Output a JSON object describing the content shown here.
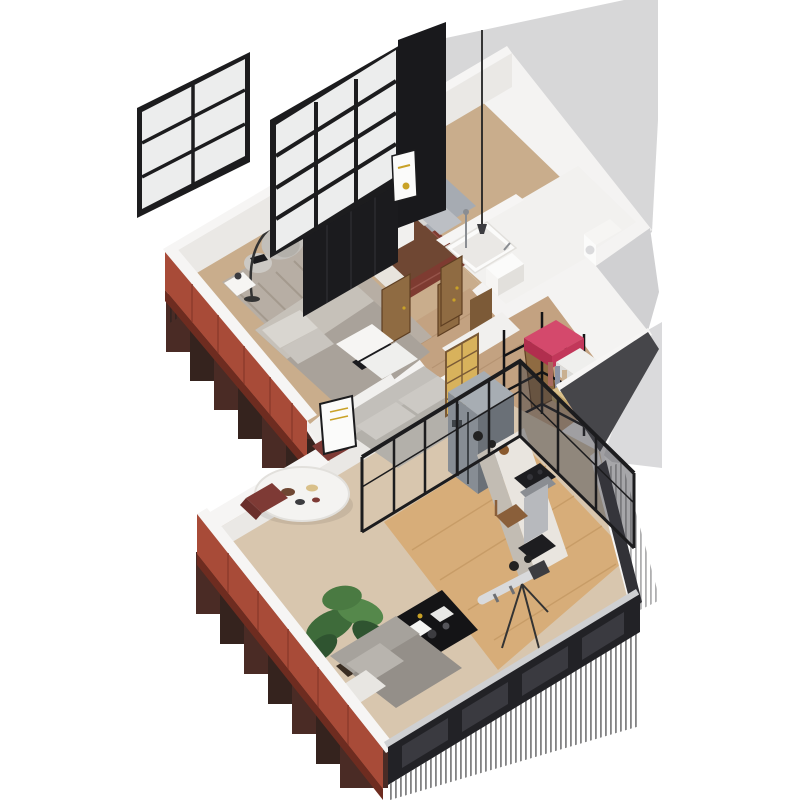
{
  "meta": {
    "type": "isometric-3d-floorplan-render",
    "view": "cutaway axonometric apartment visualization",
    "background": "#ffffff",
    "visible_text": "none"
  },
  "palette": {
    "bg": "#ffffff",
    "silhouette": "#f4f3f2",
    "wallTop": "#f6f5f4",
    "wallInner": "#eae8e5",
    "wallFace": "#f1f0ee",
    "grayWall": "#d7d7d8",
    "grayBand": "#dadadc",
    "grayBand2": "#d0d0d2",
    "darkWedge": "#46464a",
    "red": "#a84b38",
    "redDark": "#8c3a2c",
    "redShadow": "#6e2c20",
    "step1": "#3b1a13",
    "step2": "#24110c",
    "stripe": "#1b1b1d",
    "frame": "#1c1c1e",
    "glass": "#eceded",
    "slab": "#19191c",
    "blackFurn": "#1b1b1e",
    "blackFurnTop": "#333338",
    "woodFloor": "#c9ad8c",
    "hallFloor": "#c3a281",
    "plank": "#b2906f",
    "studioFloor": "#d7ad79",
    "studioPlank": "#c59a64",
    "livingFloor": "#d8c6ae",
    "rugGray": "#b7aea4",
    "rugStripe": "#a49a8e",
    "rugRed": "#7e3b31",
    "rugRedLight": "#96544a",
    "bed1": "#a9a29a",
    "bed1Light": "#c6c1b9",
    "pillow": "#d9d6d0",
    "pillow2": "#c9c5bf",
    "bed2": "#6f4733",
    "sheet": "#e8e4dd",
    "headboard": "#a6abb2",
    "pillowB": "#d8d7d4",
    "pillowB2": "#bcbfc4",
    "white": "#fbfbfa",
    "porcelain": "#f6f5f3",
    "tile": "#f2f1ef",
    "steel": "#b7b9bd",
    "steelDark": "#8a8d92",
    "doorWood": "#8f6b42",
    "doorWoodDark": "#5f3f22",
    "doorWood2": "#7c5a37",
    "gold": "#c9a227",
    "shojiGold": "#d8b25c",
    "shojiFrame": "#7a5a36",
    "shelf": "#141416",
    "suitcase": "#c2375a",
    "suitcaseTop": "#d4496c",
    "suitcaseDark": "#b12e4e",
    "boxWhite": "#efefed",
    "boxWhite2": "#dcdcda",
    "basket": "#d9c08a",
    "basketDark": "#c0a469",
    "tableWhite": "#f4f3f1",
    "tableRim": "#e2e0dc",
    "chairMaroon": "#7e3a35",
    "chairMaroonDark": "#6a2f2b",
    "sofaBack": "#c2bfba",
    "sofaSeat": "#b3b0aa",
    "sofaCushion": "#ccc9c4",
    "sofa2Back": "#a6a29c",
    "sofa2Seat": "#948f89",
    "sofa2Cushion": "#b8b4ae",
    "blanketWhite": "#e8e6e2",
    "plantPot": "#3a2d22",
    "green1": "#3e6b3a",
    "green2": "#55884b",
    "green3": "#2f5430",
    "green4": "#4a7a42",
    "fridgeTop": "#a7adb3",
    "fridgeL": "#878d94",
    "fridgeR": "#6a7077",
    "fridgeHandle": "#3f4449",
    "counterTop": "#e9e5df",
    "counterFace": "#c2bcb3",
    "stove": "#1d1d20",
    "darkWallB": "#222226",
    "darkWallB2": "#3a3a40",
    "darkWallR": "#323237",
    "lightStrip": "#cfd0d2",
    "lens": "#d9dadc",
    "lensDark": "#6d6f73",
    "tripod": "#333333",
    "deskChair": "#5b3f2a",
    "chairWood": "#8a5f3a",
    "lampMetal": "#3c3c40",
    "cord": "#222222",
    "paper": "#f5f5f3",
    "paper2": "#e8e8e6",
    "camBody": "#3c3c40",
    "camBody2": "#55555a",
    "potBlack": "#222222",
    "bowlWood": "#8a5a2e",
    "shadow": "#000000"
  },
  "scene": {
    "upper_unit": {
      "exterior_walls": {
        "southwest": "terracotta red panels",
        "northwest": "white with loft windows",
        "northeast": "tall light-gray wall"
      },
      "windows": [
        "small-loft-window 2x3 panes",
        "large-loft-window 3x4 panes"
      ],
      "rooms": [
        {
          "name": "bedroom-1",
          "furniture": [
            "double-bed gray striped bedding",
            "striped gray rug",
            "lounge armchair",
            "arc floor lamp",
            "pouf side table with books",
            "nightstand with lamp",
            "black wardrobe row"
          ]
        },
        {
          "name": "bedroom-2",
          "furniture": [
            "double-bed brown blanket",
            "gray upholstered headboard with pillows",
            "dark red rug",
            "white desk",
            "wooden chair",
            "white wall-art frame with gold dot"
          ]
        },
        {
          "name": "bathroom",
          "furniture": [
            "bathtub",
            "washbasin on white cabinet",
            "shower riser",
            "black pendant lamp on long cord"
          ]
        },
        {
          "name": "wc-laundry",
          "furniture": [
            "washing machine"
          ]
        },
        {
          "name": "hallway",
          "furniture": [
            "wooden swing doors x4"
          ]
        },
        {
          "name": "storage-room",
          "furniture": [
            "black metal shelving",
            "pink suitcase",
            "white storage boxes",
            "woven basket",
            "hanging clothes",
            "open wooden door"
          ]
        }
      ]
    },
    "lower_unit": {
      "exterior_walls": {
        "southwest": "terracotta red panels",
        "southeast": "charcoal glazed wall",
        "northwest": "white parapet"
      },
      "rooms": [
        {
          "name": "living-dining",
          "furniture": [
            "round white dining table with tableware",
            "two maroon chairs",
            "gray fabric sofa",
            "leaning white wall-art with gold lines",
            "potted plant",
            "two white console tables"
          ]
        },
        {
          "name": "kitchen",
          "furniture": [
            "stainless refrigerator",
            "counter run with marble top",
            "gas cooktop x2",
            "range hood",
            "pots and wooden bowl",
            "shoji glass door with golden panes"
          ]
        },
        {
          "name": "studio",
          "furniture": [
            "black framed glass partition",
            "black coffee table with papers and cameras",
            "telephoto lens on tripod",
            "gray sofa with white throw",
            "wooden chair"
          ]
        }
      ]
    },
    "artifacts": [
      "stepped maroon shadow under upper red wall",
      "stepped maroon shadow under lower red wall",
      "vertical striped reflection under charcoal walls"
    ]
  }
}
